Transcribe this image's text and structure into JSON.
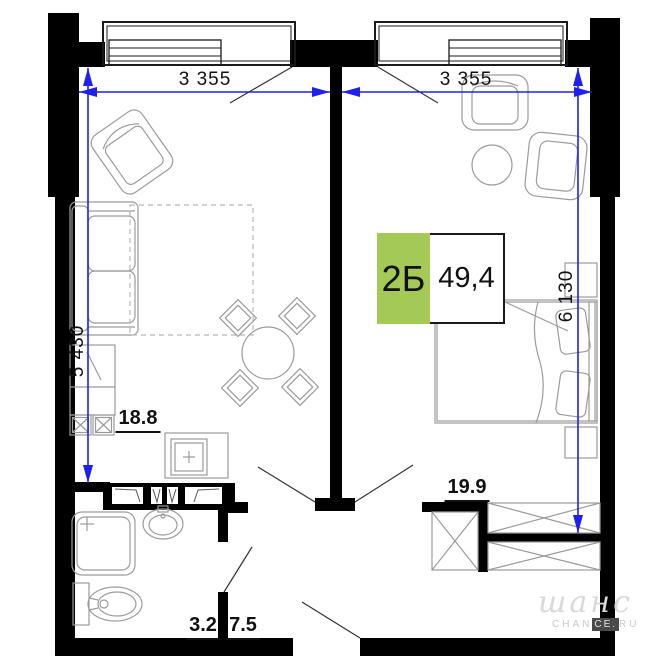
{
  "plan": {
    "badge": {
      "type_label": "2Б",
      "area_value": "49,4"
    },
    "dimensions": {
      "top_left": "3 355",
      "top_right": "3 355",
      "left_vertical": "5 430",
      "right_vertical": "6 130"
    },
    "rooms": [
      {
        "id": "living-kitchen",
        "area_label": "18.8"
      },
      {
        "id": "bedroom",
        "area_label": "19.9"
      },
      {
        "id": "bathroom",
        "area_label": "3.2"
      },
      {
        "id": "hallway",
        "area_label": "7.5"
      }
    ],
    "colors": {
      "wall_black": "#000000",
      "dimension_blue": "#2020ee",
      "badge_green": "#a4c956",
      "furniture_gray": "#9b9b9b"
    },
    "watermark": {
      "script": "шанс",
      "caption_prefix": "CHAN",
      "caption_boxed": "CE.",
      "caption_suffix": "RU"
    }
  }
}
